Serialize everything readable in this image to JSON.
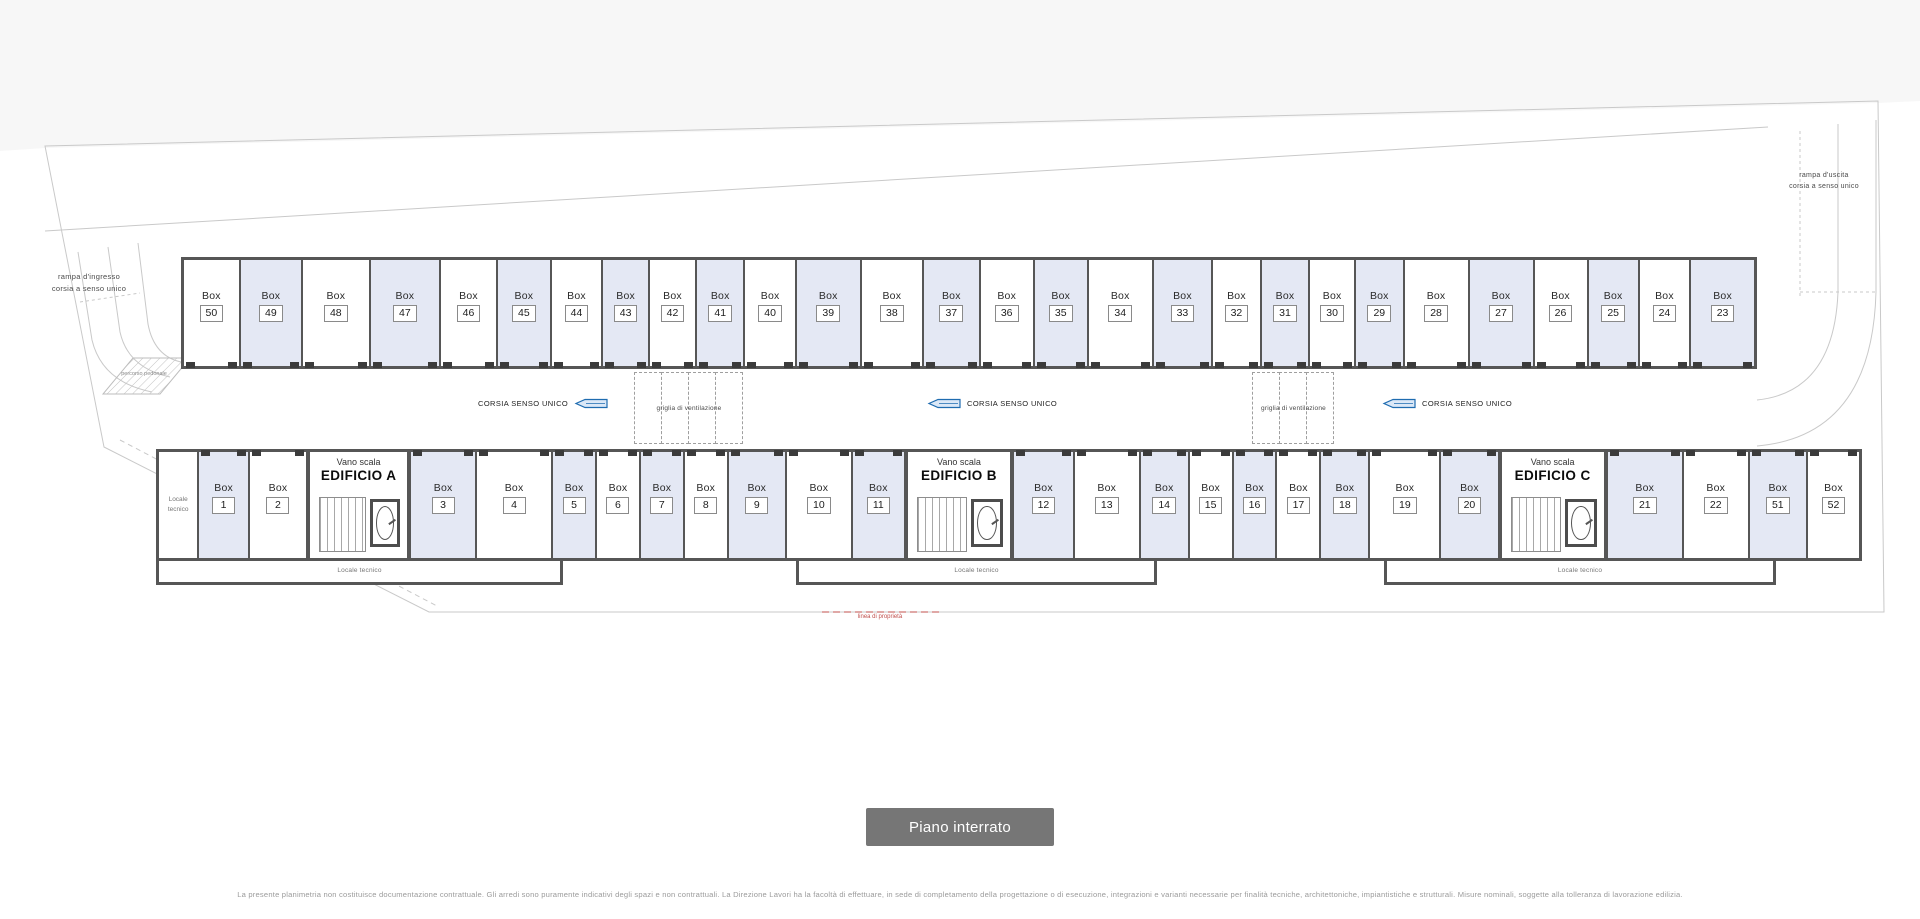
{
  "plan": {
    "box_word": "Box",
    "stair_label": "Vano scala",
    "tech_room": "Locale tecnico",
    "one_way_label": "CORSIA SENSO UNICO",
    "vent_label": "griglia di ventilazione",
    "ramp_in_line1": "rampa d'ingresso",
    "ramp_in_line2": "corsia a senso unico",
    "ramp_out_line1": "rampa d'uscita",
    "ramp_out_line2": "corsia a senso unico",
    "property_line_label": "linea di proprietà",
    "pedestrian_label": "percorso pedonale",
    "top_row": [
      {
        "num": "50",
        "shaded": false,
        "w": 1.0
      },
      {
        "num": "49",
        "shaded": true,
        "w": 1.1
      },
      {
        "num": "48",
        "shaded": false,
        "w": 1.2
      },
      {
        "num": "47",
        "shaded": true,
        "w": 1.25
      },
      {
        "num": "46",
        "shaded": false,
        "w": 1.0
      },
      {
        "num": "45",
        "shaded": true,
        "w": 0.95
      },
      {
        "num": "44",
        "shaded": false,
        "w": 0.9
      },
      {
        "num": "43",
        "shaded": true,
        "w": 0.82
      },
      {
        "num": "42",
        "shaded": false,
        "w": 0.82
      },
      {
        "num": "41",
        "shaded": true,
        "w": 0.85
      },
      {
        "num": "40",
        "shaded": false,
        "w": 0.9
      },
      {
        "num": "39",
        "shaded": true,
        "w": 1.15
      },
      {
        "num": "38",
        "shaded": false,
        "w": 1.1
      },
      {
        "num": "37",
        "shaded": true,
        "w": 1.0
      },
      {
        "num": "36",
        "shaded": false,
        "w": 0.95
      },
      {
        "num": "35",
        "shaded": true,
        "w": 0.95
      },
      {
        "num": "34",
        "shaded": false,
        "w": 1.15
      },
      {
        "num": "33",
        "shaded": true,
        "w": 1.05
      },
      {
        "num": "32",
        "shaded": false,
        "w": 0.85
      },
      {
        "num": "31",
        "shaded": true,
        "w": 0.85
      },
      {
        "num": "30",
        "shaded": false,
        "w": 0.8
      },
      {
        "num": "29",
        "shaded": true,
        "w": 0.85
      },
      {
        "num": "28",
        "shaded": false,
        "w": 1.15
      },
      {
        "num": "27",
        "shaded": true,
        "w": 1.15
      },
      {
        "num": "26",
        "shaded": false,
        "w": 0.95
      },
      {
        "num": "25",
        "shaded": true,
        "w": 0.9
      },
      {
        "num": "24",
        "shaded": false,
        "w": 0.9
      },
      {
        "num": "23",
        "shaded": true,
        "w": 1.15
      }
    ],
    "bottom_row": [
      {
        "type": "tech",
        "w": 0.75
      },
      {
        "type": "box",
        "num": "1",
        "shaded": true,
        "w": 0.95
      },
      {
        "type": "box",
        "num": "2",
        "shaded": false,
        "w": 1.1
      },
      {
        "type": "stair",
        "name": "EDIFICIO A",
        "w": 1.9
      },
      {
        "type": "box",
        "num": "3",
        "shaded": true,
        "w": 1.25
      },
      {
        "type": "box",
        "num": "4",
        "shaded": false,
        "w": 1.45
      },
      {
        "type": "box",
        "num": "5",
        "shaded": true,
        "w": 0.82
      },
      {
        "type": "box",
        "num": "6",
        "shaded": false,
        "w": 0.82
      },
      {
        "type": "box",
        "num": "7",
        "shaded": true,
        "w": 0.82
      },
      {
        "type": "box",
        "num": "8",
        "shaded": false,
        "w": 0.82
      },
      {
        "type": "box",
        "num": "9",
        "shaded": true,
        "w": 1.1
      },
      {
        "type": "box",
        "num": "10",
        "shaded": false,
        "w": 1.25
      },
      {
        "type": "box",
        "num": "11",
        "shaded": true,
        "w": 1.0
      },
      {
        "type": "stair",
        "name": "EDIFICIO B",
        "w": 2.0
      },
      {
        "type": "box",
        "num": "12",
        "shaded": true,
        "w": 1.15
      },
      {
        "type": "box",
        "num": "13",
        "shaded": false,
        "w": 1.25
      },
      {
        "type": "box",
        "num": "14",
        "shaded": true,
        "w": 0.92
      },
      {
        "type": "box",
        "num": "15",
        "shaded": false,
        "w": 0.82
      },
      {
        "type": "box",
        "num": "16",
        "shaded": true,
        "w": 0.82
      },
      {
        "type": "box",
        "num": "17",
        "shaded": false,
        "w": 0.82
      },
      {
        "type": "box",
        "num": "18",
        "shaded": true,
        "w": 0.92
      },
      {
        "type": "box",
        "num": "19",
        "shaded": false,
        "w": 1.35
      },
      {
        "type": "box",
        "num": "20",
        "shaded": true,
        "w": 1.1
      },
      {
        "type": "stair",
        "name": "EDIFICIO C",
        "w": 2.0
      },
      {
        "type": "box",
        "num": "21",
        "shaded": true,
        "w": 1.45
      },
      {
        "type": "box",
        "num": "22",
        "shaded": false,
        "w": 1.25
      },
      {
        "type": "box",
        "num": "51",
        "shaded": true,
        "w": 1.1
      },
      {
        "type": "box",
        "num": "52",
        "shaded": false,
        "w": 1.0
      }
    ]
  },
  "footer": {
    "floor_button_label": "Piano interrato",
    "disclaimer": "La presente planimetria non costituisce documentazione contrattuale. Gli arredi sono puramente indicativi degli spazi e non contrattuali. La Direzione Lavori ha la facoltà di effettuare, in sede di completamento della progettazione o di esecuzione, integrazioni e varianti necessarie per finalità tecniche, architettoniche, impiantistiche e strutturali. Misure nominali, soggette alla tolleranza di lavorazione edilizia."
  },
  "colors": {
    "box_fill": "#e4e8f4",
    "wall": "#565656",
    "arrow_blue": "#1f6cb0",
    "button_bg": "#767676",
    "property_red": "#c0504d"
  }
}
